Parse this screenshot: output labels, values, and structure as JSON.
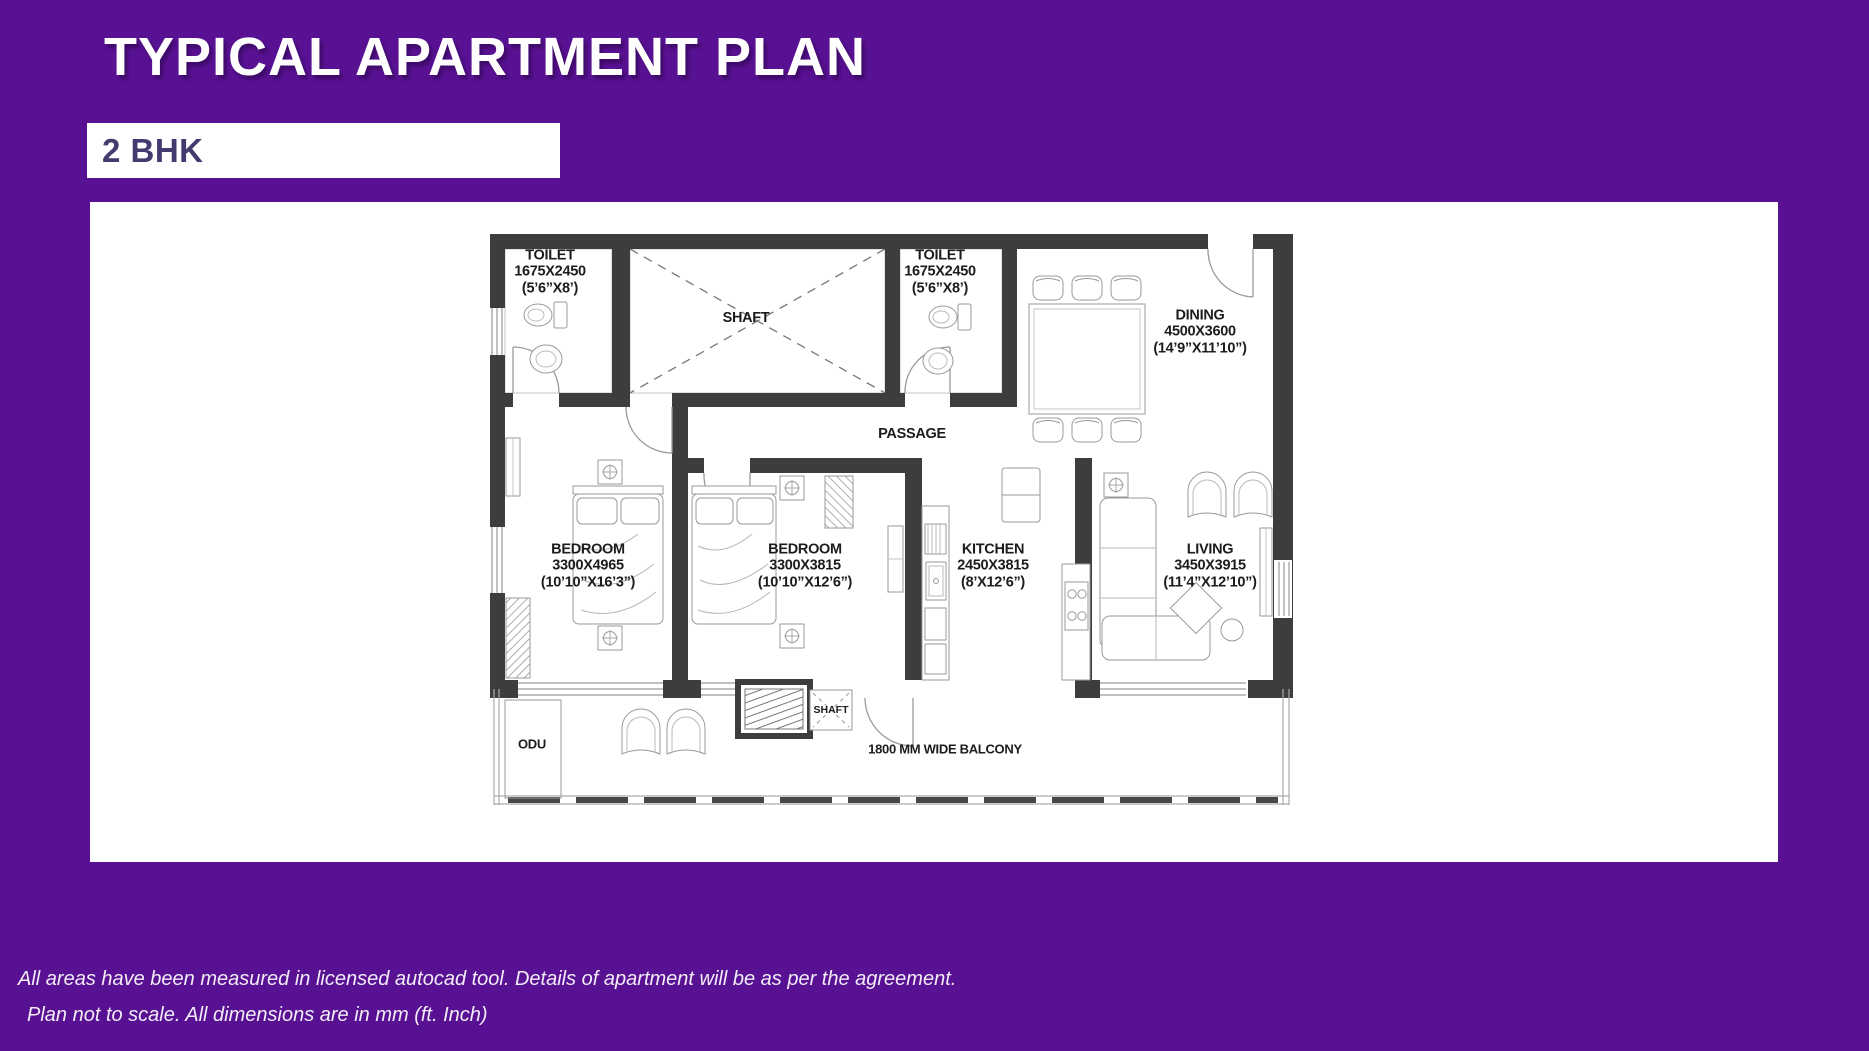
{
  "header": {
    "title": "TYPICAL APARTMENT PLAN",
    "unit_type": "2 BHK"
  },
  "plan": {
    "rooms": [
      {
        "id": "toilet-1",
        "name": "TOILET",
        "dim_mm": "1675X2450",
        "dim_ft": "(5’6”X8’)"
      },
      {
        "id": "shaft-top",
        "name": "SHAFT"
      },
      {
        "id": "toilet-2",
        "name": "TOILET",
        "dim_mm": "1675X2450",
        "dim_ft": "(5’6”X8’)"
      },
      {
        "id": "dining",
        "name": "DINING",
        "dim_mm": "4500X3600",
        "dim_ft": "(14’9”X11’10”)"
      },
      {
        "id": "passage",
        "name": "PASSAGE"
      },
      {
        "id": "bedroom-1",
        "name": "BEDROOM",
        "dim_mm": "3300X4965",
        "dim_ft": "(10’10”X16’3”)"
      },
      {
        "id": "bedroom-2",
        "name": "BEDROOM",
        "dim_mm": "3300X3815",
        "dim_ft": "(10’10”X12’6”)"
      },
      {
        "id": "kitchen",
        "name": "KITCHEN",
        "dim_mm": "2450X3815",
        "dim_ft": "(8’X12’6”)"
      },
      {
        "id": "living",
        "name": "LIVING",
        "dim_mm": "3450X3915",
        "dim_ft": "(11’4”X12’10”)"
      },
      {
        "id": "odu",
        "name": "ODU"
      },
      {
        "id": "shaft-balcony",
        "name": "SHAFT"
      },
      {
        "id": "balcony",
        "name": "1800 MM WIDE BALCONY"
      }
    ]
  },
  "footnotes": {
    "line1": "All areas have been measured in licensed autocad tool. Details of apartment will be as per the agreement.",
    "line2": "Plan not to scale. All dimensions are in mm (ft. Inch)"
  },
  "colors": {
    "background": "#581192",
    "panel": "#ffffff",
    "wall": "#3d3d3d",
    "unit_text": "#433a70",
    "label_text": "#1c1c1c"
  }
}
